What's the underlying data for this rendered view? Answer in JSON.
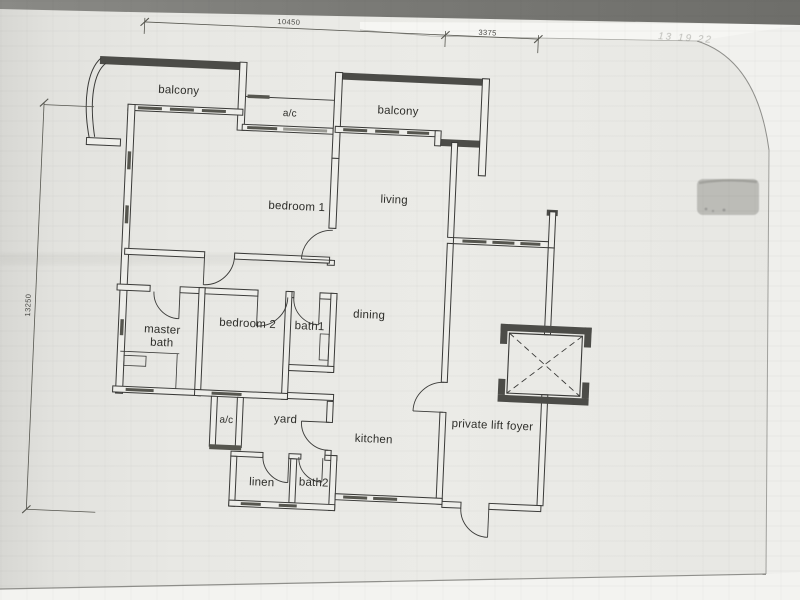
{
  "document": {
    "kind": "architectural floor plan (photographed page)",
    "handwritten_note": "13 19 22"
  },
  "rooms": [
    {
      "id": "balcony-1",
      "label": "balcony"
    },
    {
      "id": "ac-1",
      "label": "a/c"
    },
    {
      "id": "balcony-2",
      "label": "balcony"
    },
    {
      "id": "bedroom-1",
      "label": "bedroom 1"
    },
    {
      "id": "living",
      "label": "living"
    },
    {
      "id": "master-bath",
      "label": "master bath"
    },
    {
      "id": "bedroom-2",
      "label": "bedroom 2"
    },
    {
      "id": "bath-1",
      "label": "bath1"
    },
    {
      "id": "dining",
      "label": "dining"
    },
    {
      "id": "ac-2",
      "label": "a/c"
    },
    {
      "id": "yard",
      "label": "yard"
    },
    {
      "id": "kitchen",
      "label": "kitchen"
    },
    {
      "id": "linen",
      "label": "linen"
    },
    {
      "id": "bath-2",
      "label": "bath2"
    },
    {
      "id": "private-lift-foyer",
      "label": "private lift foyer"
    }
  ],
  "dimensions": {
    "top_width": {
      "label": "10450"
    },
    "top_right_width": {
      "label": "3375"
    },
    "left_height": {
      "label": "13250"
    }
  },
  "colors": {
    "paper": "#e8e8e4",
    "ink": "#3a3a38",
    "wall_fill": "#4c4c48",
    "photo_band": "#7c7c78"
  }
}
